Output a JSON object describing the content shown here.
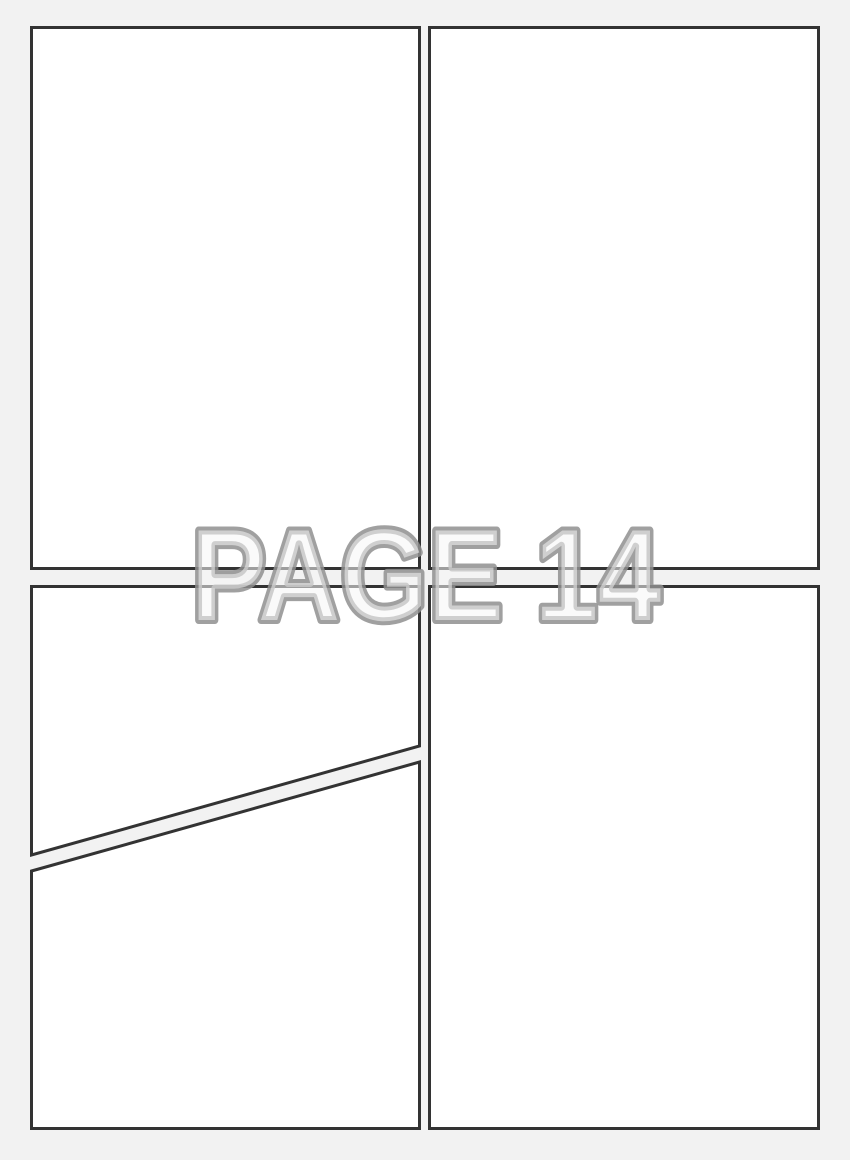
{
  "page": {
    "watermark_text": "PAGE 14"
  },
  "colors": {
    "background": "#f2f2f2",
    "panel_fill": "#ffffff",
    "panel_border": "#333333",
    "watermark_fill": "#f5f5f5",
    "watermark_outline": "#8f8f8f"
  },
  "panels": [
    {
      "id": "panel-top-left"
    },
    {
      "id": "panel-top-right"
    },
    {
      "id": "panel-bottom-left-upper"
    },
    {
      "id": "panel-bottom-left-lower"
    },
    {
      "id": "panel-bottom-right"
    }
  ]
}
